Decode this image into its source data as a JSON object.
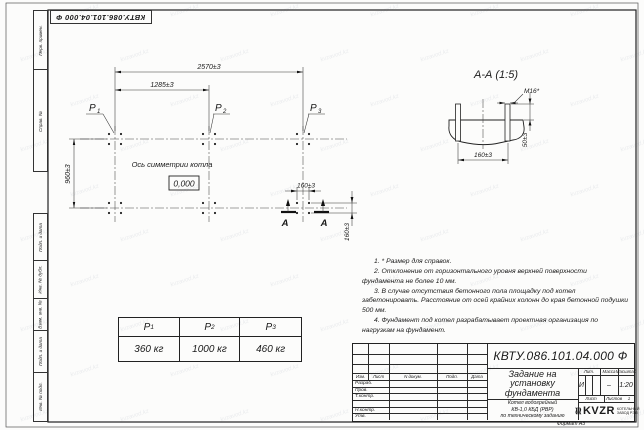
{
  "sheet": {
    "watermark_text": "kvzavod.kz",
    "format_note": "Формат А3"
  },
  "frame": {
    "top_designation": "КВТУ.086.101.04.000  Ф",
    "side_labels_top": [
      "Перв. примен.",
      "Справ. №"
    ],
    "side_labels_bottom": [
      "Подп. и дата",
      "Инв. № дубл.",
      "Взам. инв. №",
      "Подп. и дата",
      "Инв. № подл."
    ]
  },
  "plan": {
    "dim_overall": "2570±3",
    "dim_half": "1285±3",
    "dim_depth": "960±3",
    "dim_bolt_x": "160±3",
    "dim_bolt_y": "160±3",
    "axis_label": "Ось симметрии котла",
    "level_mark": "0,000",
    "section_mark": "А",
    "loads": [
      {
        "name": "P",
        "sub": "1"
      },
      {
        "name": "P",
        "sub": "2"
      },
      {
        "name": "P",
        "sub": "3"
      }
    ]
  },
  "section": {
    "title": "А-А (1:5)",
    "thread_label": "М16*",
    "dim_spacing": "160±3",
    "dim_height": "50±3"
  },
  "notes": [
    "1. * Размер для справок.",
    "2. Отклонение от горизонтального уровня верхней поверхности фундамента не более 10 мм.",
    "3. В случае отсутствия бетонного пола площадку под котел забетонировать. Расстояние от осей крайних колонн до края бетонной подушки 500 мм.",
    "4. Фундамент под котел разрабатывает проектная организация по нагрузкам на фундамент."
  ],
  "load_table": {
    "headers": [
      {
        "name": "P",
        "sub": "1"
      },
      {
        "name": "P",
        "sub": "2"
      },
      {
        "name": "P",
        "sub": "3"
      }
    ],
    "values": [
      "360 кг",
      "1000 кг",
      "460 кг"
    ]
  },
  "title_block": {
    "designation": "КВТУ.086.101.04.000  Ф",
    "doc_title": "Задание на установку фундамента",
    "product_lines": [
      "Котел водогрейный",
      "КВ-1,0 КБД (РВР)",
      "по техническому заданию"
    ],
    "header_cols": [
      "Изм.",
      "Лист",
      "N докум.",
      "Подп.",
      "Дата"
    ],
    "sign_rows": [
      "Разраб.",
      "Пров.",
      "Т.контр.",
      "",
      "Н.контр.",
      "Утв."
    ],
    "lit_label": "Лит.",
    "mass_label": "Масса",
    "scale_label": "Масштаб",
    "lit_value": "И",
    "mass_value": "–",
    "scale_value": "1:20",
    "sheet_label": "Лист",
    "sheets_label": "Листов",
    "sheets_value": "1",
    "logo_text": "KVZR",
    "logo_caption_1": "КОТЕЛЬНЫЙ",
    "logo_caption_2": "ЗАВОД РЭП"
  }
}
